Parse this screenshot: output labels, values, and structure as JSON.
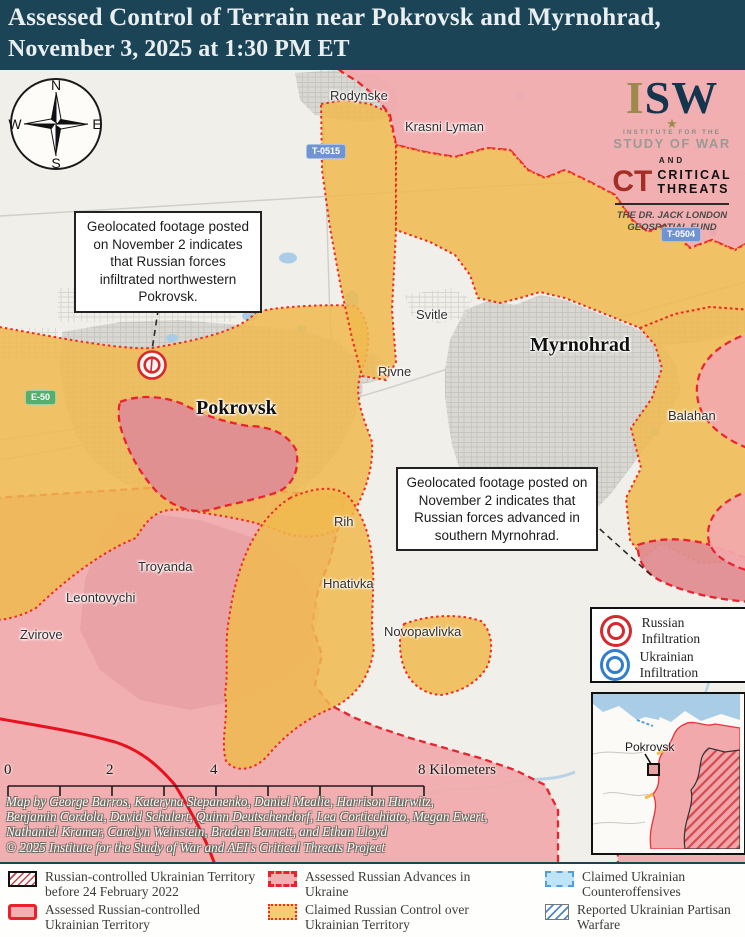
{
  "header": {
    "title": "Assessed Control of Terrain near Pokrovsk and Myrnohrad,",
    "date_line": "November 3, 2025 at 1:30 PM ET"
  },
  "branding": {
    "isw_i": "I",
    "isw_sw": "SW",
    "star": "★",
    "inst_line": "INSTITUTE FOR THE",
    "study_line": "STUDY OF WAR",
    "conjunction": "AND",
    "ct": "CT",
    "ct_line1": "CRITICAL",
    "ct_line2": "THREATS",
    "fund_line1": "THE DR. JACK LONDON",
    "fund_line2": "GEOSPATIAL FUND"
  },
  "compass": {
    "north": "N",
    "east": "E",
    "south": "S",
    "west": "W"
  },
  "annotations": [
    {
      "text": "Geolocated footage posted on November 2 indicates that Russian forces infiltrated northwestern Pokrovsk."
    },
    {
      "text": "Geolocated footage posted on November 2 indicates that Russian forces advanced in southern Myrnohrad."
    }
  ],
  "settlements": [
    {
      "name": "Rodynske",
      "major": false
    },
    {
      "name": "Krasni Lyman",
      "major": false
    },
    {
      "name": "Svitle",
      "major": false
    },
    {
      "name": "Myrnohrad",
      "major": true
    },
    {
      "name": "Rivne",
      "major": false
    },
    {
      "name": "Pokrovsk",
      "major": true
    },
    {
      "name": "Balahan",
      "major": false
    },
    {
      "name": "Rih",
      "major": false
    },
    {
      "name": "Hnativka",
      "major": false
    },
    {
      "name": "Troyanda",
      "major": false
    },
    {
      "name": "Leontovychi",
      "major": false
    },
    {
      "name": "Zvirove",
      "major": false
    },
    {
      "name": "Novopavlivka",
      "major": false
    }
  ],
  "road_badges": [
    {
      "label": "T-0515",
      "style": "blue"
    },
    {
      "label": "T-0504",
      "style": "blue"
    },
    {
      "label": "E-50",
      "style": "green"
    }
  ],
  "infiltration_legend": [
    {
      "label": "Russian Infiltration",
      "color": "#d7282f"
    },
    {
      "label": "Ukrainian Infiltration",
      "color": "#2f7ed0"
    }
  ],
  "inset": {
    "label": "Pokrovsk"
  },
  "scale": {
    "tick0": "0",
    "tick2": "2",
    "tick4": "4",
    "tick8": "8 Kilometers"
  },
  "credits": {
    "line1": "Map by George Barros, Kateryna Stepanenko, Daniel Mealie, Harrison Hurwitz,",
    "line2": "Benjamin Cordola, David Schulert, Quinn Deutschendorf, Lea Corticchiato, Megan Ewert,",
    "line3": "Nathaniel Kramer, Carolyn Weinstein, Braden Barnett, and Ethan Lloyd",
    "line4": "© 2025 Institute for the Study of War and AEI's Critical Threats Project"
  },
  "legend": {
    "items": [
      {
        "label": "Russian-controlled Ukrainian Territory before 24 February 2022",
        "swatch": "prewar"
      },
      {
        "label": "Assessed Russian-controlled Ukrainian Territory",
        "swatch": "assessed"
      },
      {
        "label": "Assessed Russian Advances in Ukraine",
        "swatch": "advance"
      },
      {
        "label": "Claimed Russian Control over Ukrainian Territory",
        "swatch": "claimed"
      },
      {
        "label": "Claimed Ukrainian Counteroffensives",
        "swatch": "counter"
      },
      {
        "label": "Reported Ukrainian Partisan Warfare",
        "swatch": "partisan"
      }
    ]
  },
  "colors": {
    "header_bg": "#1b4557",
    "claimed_yellow": "#f0ba4e",
    "assessed_pink": "#f2a9ac",
    "advance_pink": "#df8d92",
    "boundary_red": "#e8232e",
    "water_blue": "#a9cde6",
    "urban_gray": "#d9d8d3",
    "counteroffensive_blue": "#bfe3f7",
    "partisan_blue": "#4f86c6",
    "badge_blue": "#7094cf",
    "badge_green": "#56ae6c"
  }
}
